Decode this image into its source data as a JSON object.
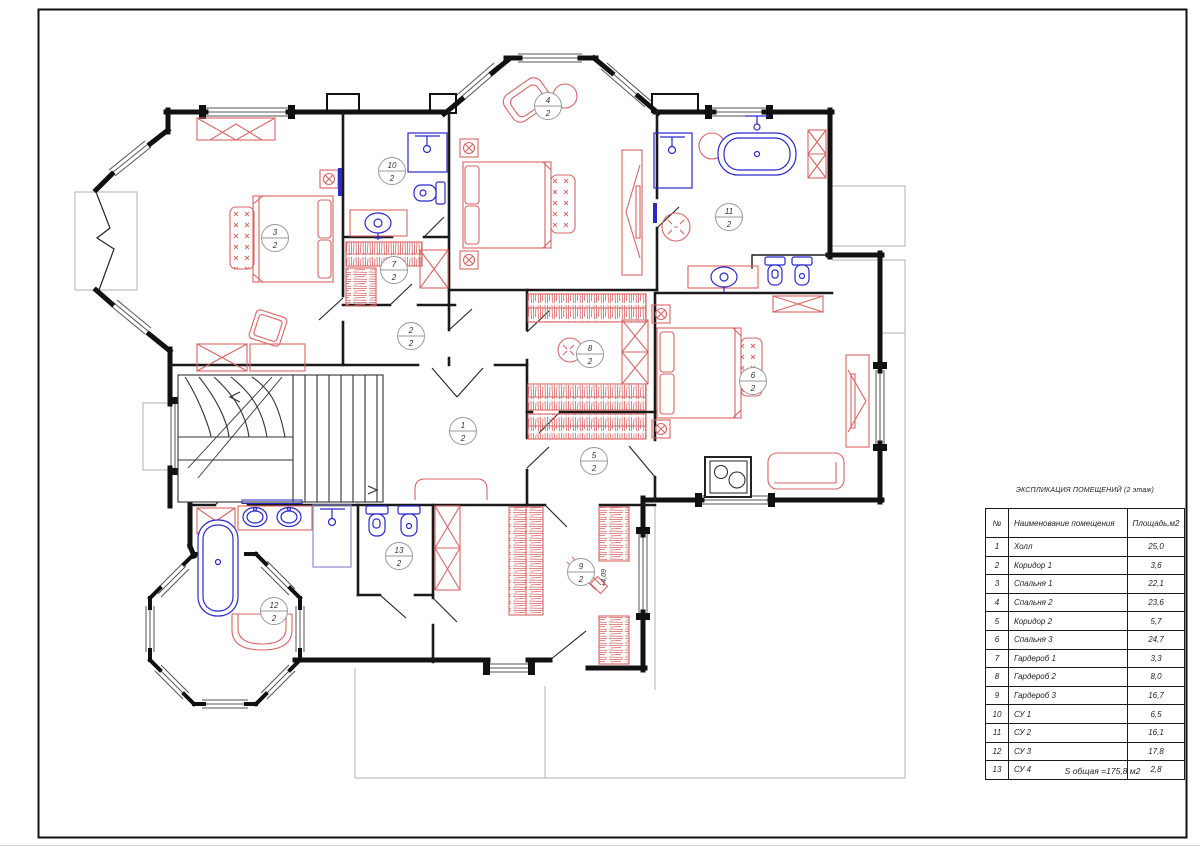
{
  "legend": {
    "title": "ЭКСПЛИКАЦИЯ ПОМЕЩЕНИЙ (2 этаж)",
    "columns": {
      "num": "№",
      "name": "Наименование помещения",
      "area": "Площадь,м2"
    },
    "rows": [
      {
        "num": "1",
        "name": "Холл",
        "area": "25,0"
      },
      {
        "num": "2",
        "name": "Коридор 1",
        "area": "3,6"
      },
      {
        "num": "3",
        "name": "Спальня 1",
        "area": "22,1"
      },
      {
        "num": "4",
        "name": "Спальня 2",
        "area": "23,6"
      },
      {
        "num": "5",
        "name": "Коридор 2",
        "area": "5,7"
      },
      {
        "num": "6",
        "name": "Спальня 3",
        "area": "24,7"
      },
      {
        "num": "7",
        "name": "Гардероб 1",
        "area": "3,3"
      },
      {
        "num": "8",
        "name": "Гардероб 2",
        "area": "8,0"
      },
      {
        "num": "9",
        "name": "Гардероб 3",
        "area": "16,7"
      },
      {
        "num": "10",
        "name": "СУ 1",
        "area": "6,5"
      },
      {
        "num": "11",
        "name": "СУ 2",
        "area": "16,1"
      },
      {
        "num": "12",
        "name": "СУ 3",
        "area": "17,8"
      },
      {
        "num": "13",
        "name": "СУ 4",
        "area": "2,8"
      }
    ],
    "total": "S общая =175,8 м2"
  },
  "plan": {
    "floor_note": "2 этаж",
    "elevation_label": "+4,09",
    "markers": [
      {
        "num": "1",
        "den": "2"
      },
      {
        "num": "2",
        "den": "2"
      },
      {
        "num": "3",
        "den": "2"
      },
      {
        "num": "4",
        "den": "2"
      },
      {
        "num": "5",
        "den": "2"
      },
      {
        "num": "6",
        "den": "2"
      },
      {
        "num": "7",
        "den": "2"
      },
      {
        "num": "8",
        "den": "2"
      },
      {
        "num": "9",
        "den": "2"
      },
      {
        "num": "10",
        "den": "2"
      },
      {
        "num": "11",
        "den": "2"
      },
      {
        "num": "12",
        "den": "2"
      },
      {
        "num": "13",
        "den": "2"
      }
    ]
  },
  "colors": {
    "walls": "#1a1a1a",
    "furniture_red": "#d96464",
    "plumbing_blue": "#2929cc",
    "construction_gray": "#b0b0b0",
    "marker_stroke": "#999999"
  }
}
